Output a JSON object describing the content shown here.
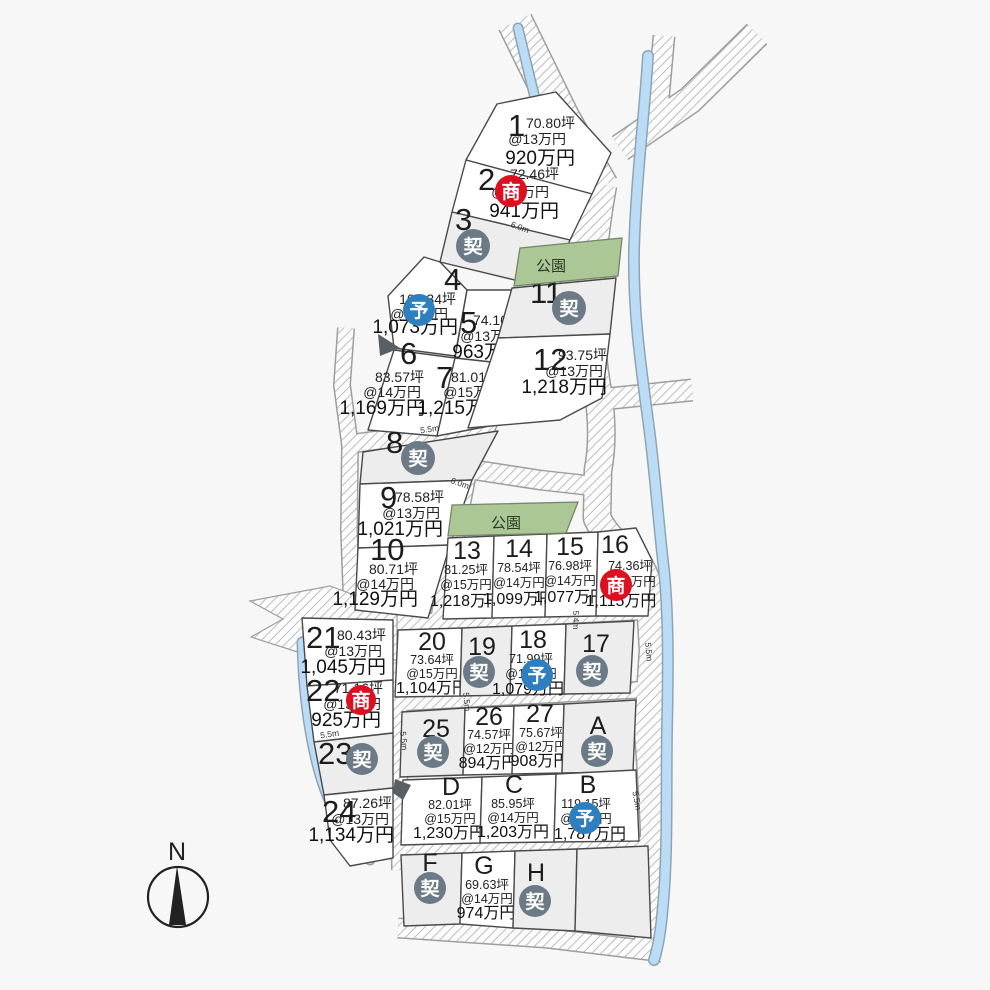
{
  "compass": {
    "label": "N"
  },
  "status_labels": {
    "negotiating": "商",
    "contracted": "契",
    "reserved": "予"
  },
  "parks": [
    {
      "label": "公園"
    },
    {
      "label": "公園"
    }
  ],
  "colors": {
    "negotiating": "#dc1021",
    "contracted": "#6c7a87",
    "reserved": "#2e7fc0",
    "park": "#abc795",
    "river": "#badcf6",
    "road_hatch": "#bdbdbd",
    "lot_available": "#ffffff",
    "lot_contracted": "#ededed"
  },
  "dims": [
    "6.0m",
    "5.5m",
    "6.0m",
    "5.4m",
    "5.5m",
    "5.5m",
    "5.5m",
    "5.5m",
    "5.5m"
  ],
  "lots": [
    {
      "no": "1",
      "area": "70.80坪",
      "unit_price": "@13万円",
      "price": "920万円",
      "status": "available"
    },
    {
      "no": "2",
      "area": "72.46坪",
      "unit_price": "@13万円",
      "price": "941万円",
      "status": "negotiating"
    },
    {
      "no": "3",
      "status": "contracted"
    },
    {
      "no": "4",
      "area": "107.34坪",
      "unit_price": "@10万円",
      "price": "1,073万円",
      "status": "reserved"
    },
    {
      "no": "5",
      "area": "74.10坪",
      "unit_price": "@13万円",
      "price": "963万円",
      "status": "available"
    },
    {
      "no": "6",
      "area": "83.57坪",
      "unit_price": "@14万円",
      "price": "1,169万円",
      "status": "available"
    },
    {
      "no": "7",
      "area": "81.01坪",
      "unit_price": "@15万円",
      "price": "1,215万円",
      "status": "available"
    },
    {
      "no": "8",
      "status": "contracted"
    },
    {
      "no": "9",
      "area": "78.58坪",
      "unit_price": "@13万円",
      "price": "1,021万円",
      "status": "available"
    },
    {
      "no": "10",
      "area": "80.71坪",
      "unit_price": "@14万円",
      "price": "1,129万円",
      "status": "available"
    },
    {
      "no": "11",
      "status": "contracted"
    },
    {
      "no": "12",
      "area": "93.75坪",
      "unit_price": "@13万円",
      "price": "1,218万円",
      "status": "available"
    },
    {
      "no": "13",
      "area": "81.25坪",
      "unit_price": "@15万円",
      "price": "1,218万円",
      "status": "available"
    },
    {
      "no": "14",
      "area": "78.54坪",
      "unit_price": "@14万円",
      "price": "1,099万円",
      "status": "available"
    },
    {
      "no": "15",
      "area": "76.98坪",
      "unit_price": "@14万円",
      "price": "1,077万円",
      "status": "available"
    },
    {
      "no": "16",
      "area": "74.36坪",
      "unit_price": "@15万円",
      "price": "1,115万円",
      "status": "negotiating"
    },
    {
      "no": "17",
      "status": "contracted"
    },
    {
      "no": "18",
      "area": "71.99坪",
      "unit_price": "@15万円",
      "price": "1,079万円",
      "status": "reserved"
    },
    {
      "no": "19",
      "status": "contracted"
    },
    {
      "no": "20",
      "area": "73.64坪",
      "unit_price": "@15万円",
      "price": "1,104万円",
      "status": "available"
    },
    {
      "no": "21",
      "area": "80.43坪",
      "unit_price": "@13万円",
      "price": "1,045万円",
      "status": "available"
    },
    {
      "no": "22",
      "area": "71.16坪",
      "unit_price": "@13万円",
      "price": "925万円",
      "status": "negotiating"
    },
    {
      "no": "23",
      "status": "contracted"
    },
    {
      "no": "24",
      "area": "87.26坪",
      "unit_price": "@13万円",
      "price": "1,134万円",
      "status": "available"
    },
    {
      "no": "25",
      "status": "contracted"
    },
    {
      "no": "26",
      "area": "74.57坪",
      "unit_price": "@12万円",
      "price": "894万円",
      "status": "available"
    },
    {
      "no": "27",
      "area": "75.67坪",
      "unit_price": "@12万円",
      "price": "908万円",
      "status": "available"
    },
    {
      "no": "A",
      "status": "contracted"
    },
    {
      "no": "B",
      "area": "119.15坪",
      "unit_price": "@15万円",
      "price": "1,787万円",
      "status": "reserved"
    },
    {
      "no": "C",
      "area": "85.95坪",
      "unit_price": "@14万円",
      "price": "1,203万円",
      "status": "available"
    },
    {
      "no": "D",
      "area": "82.01坪",
      "unit_price": "@15万円",
      "price": "1,230万円",
      "status": "available"
    },
    {
      "no": "F",
      "status": "contracted"
    },
    {
      "no": "G",
      "area": "69.63坪",
      "unit_price": "@14万円",
      "price": "974万円",
      "status": "available"
    },
    {
      "no": "H",
      "status": "contracted"
    }
  ]
}
